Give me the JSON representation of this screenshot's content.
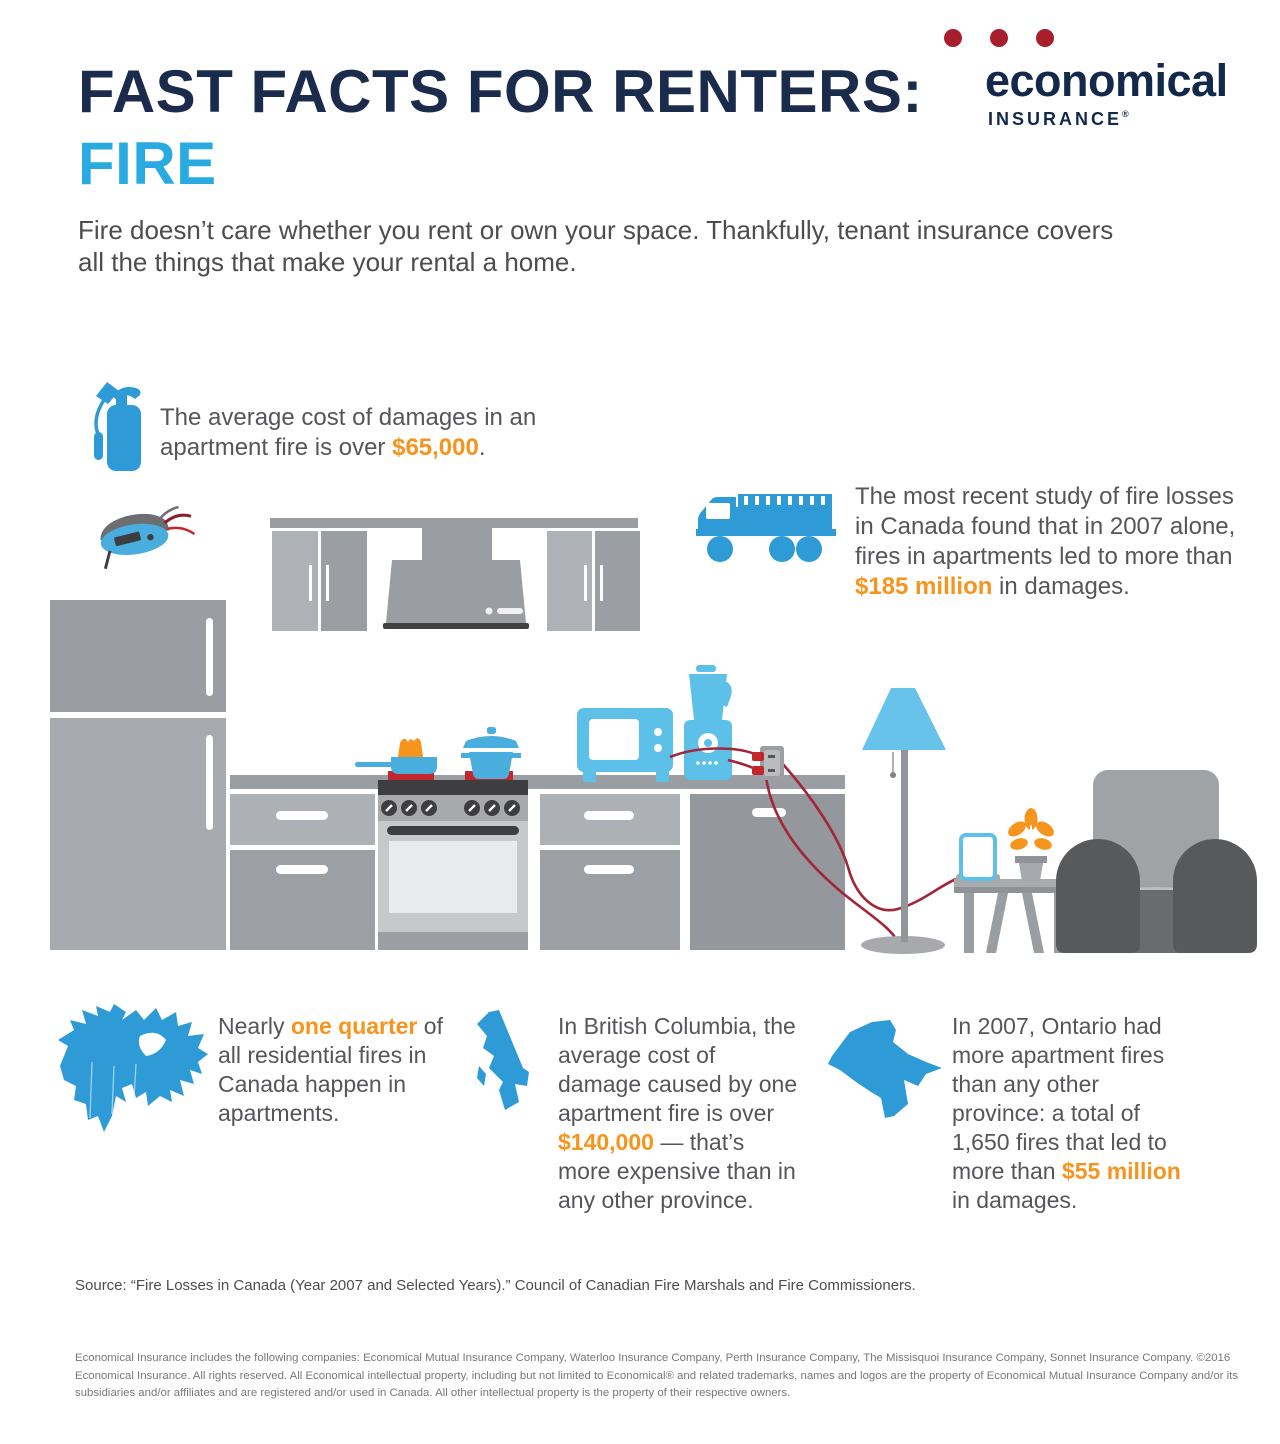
{
  "header": {
    "title_line1": "FAST FACTS FOR RENTERS:",
    "title_line2": "FIRE"
  },
  "logo": {
    "word": "economical",
    "sub": "INSURANCE",
    "reg": "®",
    "dot_color": "#A81E2D",
    "navy": "#13294B"
  },
  "intro": {
    "lines": [
      [
        {
          "t": "Fire doesn’t care whether you rent or own your space. Thankfully, tenant insurance covers"
        }
      ],
      [
        {
          "t": "all the things that make your rental a home."
        }
      ]
    ]
  },
  "facts": {
    "avg_cost": {
      "icon": "fire-extinguisher-icon",
      "highlight": "$65,000",
      "lines": [
        [
          {
            "t": "The average cost of damages in an"
          }
        ],
        [
          {
            "t": "apartment fire is over "
          },
          {
            "t": "$65,000",
            "hl": true
          },
          {
            "t": "."
          }
        ]
      ]
    },
    "study_2007": {
      "icon": "fire-truck-icon",
      "highlight": "$185 million",
      "lines": [
        [
          {
            "t": "The most recent study of fire losses"
          }
        ],
        [
          {
            "t": "in Canada found that in 2007 alone,"
          }
        ],
        [
          {
            "t": "fires in apartments led to more than"
          }
        ],
        [
          {
            "t": "$185 million",
            "hl": true
          },
          {
            "t": " in damages."
          }
        ]
      ]
    },
    "one_quarter": {
      "icon": "canada-map-icon",
      "highlight": "one quarter",
      "lines": [
        [
          {
            "t": "Nearly "
          },
          {
            "t": "one quarter",
            "hl": true
          },
          {
            "t": " of"
          }
        ],
        [
          {
            "t": "all residential fires in"
          }
        ],
        [
          {
            "t": "Canada happen in"
          }
        ],
        [
          {
            "t": "apartments."
          }
        ]
      ]
    },
    "bc": {
      "icon": "british-columbia-map-icon",
      "highlight": "$140,000",
      "lines": [
        [
          {
            "t": "In British Columbia, the"
          }
        ],
        [
          {
            "t": "average cost of"
          }
        ],
        [
          {
            "t": "damage caused by one"
          }
        ],
        [
          {
            "t": "apartment fire is over"
          }
        ],
        [
          {
            "t": "$140,000",
            "hl": true
          },
          {
            "t": " — that’s"
          }
        ],
        [
          {
            "t": "more expensive than in"
          }
        ],
        [
          {
            "t": "any other province."
          }
        ]
      ]
    },
    "ontario": {
      "icon": "ontario-map-icon",
      "highlight": "$55 million",
      "lines": [
        [
          {
            "t": "In 2007, Ontario had"
          }
        ],
        [
          {
            "t": "more apartment fires"
          }
        ],
        [
          {
            "t": "than any other"
          }
        ],
        [
          {
            "t": "province: a total of"
          }
        ],
        [
          {
            "t": "1,650 fires that led to"
          }
        ],
        [
          {
            "t": "more than "
          },
          {
            "t": "$55 million",
            "hl": true
          }
        ],
        [
          {
            "t": "in damages."
          }
        ]
      ]
    }
  },
  "source": "Source: “Fire Losses in Canada (Year 2007 and Selected Years).” Council of Canadian Fire Marshals and Fire Commissioners.",
  "legal": {
    "lines": [
      [
        {
          "t": "Economical Insurance includes the following companies: Economical Mutual Insurance Company, Waterloo Insurance Company, Perth Insurance Company, The Missisquoi Insurance Company, Sonnet Insurance Company. ©2016"
        }
      ],
      [
        {
          "t": "Economical Insurance. All rights reserved. All Economical intellectual property, including but not limited to Economical® and related trademarks, names and logos are the property of Economical Mutual Insurance Company and/or its"
        }
      ],
      [
        {
          "t": "subsidiaries and/or affiliates and are registered and/or used in Canada. All other intellectual property is the property of their respective owners."
        }
      ]
    ]
  },
  "colors": {
    "navy": "#1B2B4C",
    "fire_blue": "#29ABE2",
    "icon_blue": "#2E9BD6",
    "appliance_blue": "#5CC0E8",
    "highlight_orange": "#F7941D",
    "logo_red": "#A81E2D",
    "cord_red": "#A32638",
    "burner_red": "#C1272D",
    "body_text": "#54565A",
    "legal_text": "#77787B"
  },
  "scene_icons": [
    "smoke-detector-icon",
    "fridge",
    "upper-cabinets",
    "range-hood",
    "kitchen-counter",
    "stove",
    "frying-pan-on-fire-icon",
    "cooking-pot-icon",
    "microwave-icon",
    "blender-icon",
    "power-outlet-icon",
    "power-cords",
    "floor-lamp-icon",
    "phone-charging-icon",
    "potted-plant-icon",
    "side-table",
    "armchair"
  ]
}
